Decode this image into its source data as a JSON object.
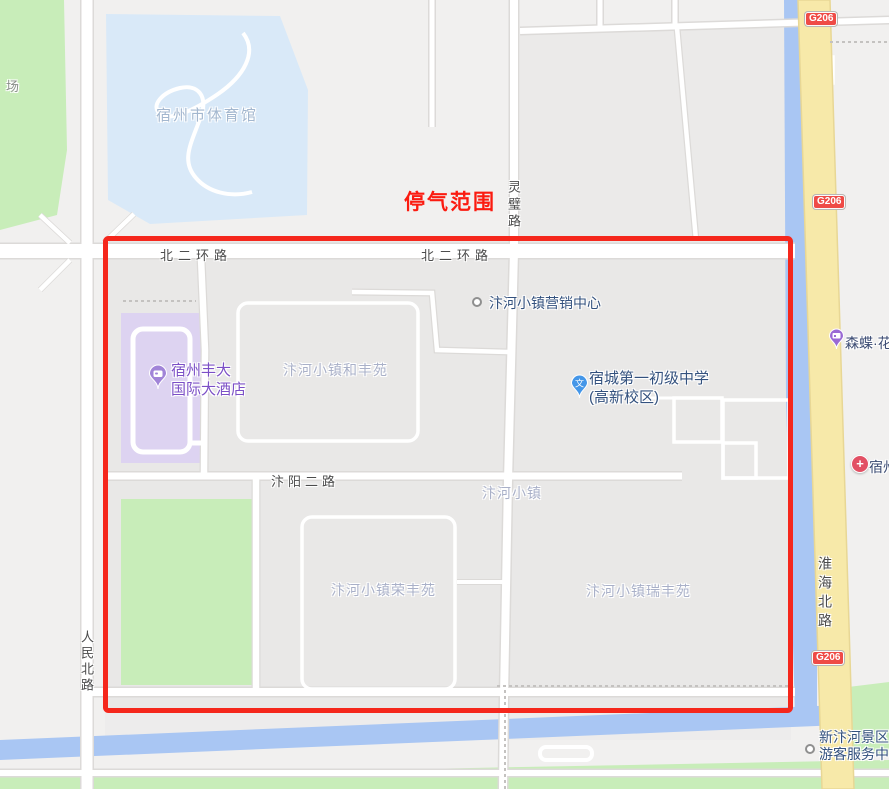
{
  "overlay": {
    "label": "停气范围"
  },
  "road_labels": {
    "beierhuan_left": "北二环路",
    "beierhuan_center": "北二环路",
    "lingbi": "灵璧路",
    "bianyang_er": "汴阳二路",
    "renmin_bei": "人民北路",
    "huaihai_bei": "淮海北路"
  },
  "highway_badge": "G206",
  "poi": {
    "chang": "场",
    "gym": "宿州市体育馆",
    "marketing": "汴河小镇营销中心",
    "hotel_line1": "宿州丰大",
    "hotel_line2": "国际大酒店",
    "school_line1": "宿城第一初级中学",
    "school_line2": "(高新校区)",
    "flower": "森蝶·花",
    "hospital": "宿州",
    "scenic_line1": "新汴河景区",
    "scenic_line2": "游客服务中"
  },
  "areas": {
    "hefeng": "汴河小镇和丰苑",
    "town": "汴河小镇",
    "rongfeng": "汴河小镇荣丰苑",
    "ruifeng": "汴河小镇瑞丰苑"
  },
  "icons": {
    "school_pin_glyph": "文",
    "hospital_cross": "+"
  },
  "colors": {
    "overlay_red": "#f5271c",
    "park_green": "#c8edb9",
    "water_blue": "#a9c6f3",
    "gym_area_blue": "#d9e9f8",
    "hotel_area_purple": "#ddd3f1",
    "hotel_text_purple": "#7b4fc6",
    "poi_text_blue": "#33517e",
    "area_label_grey": "#a9b0c8",
    "road_label_grey": "#4c4c4c",
    "highway_yellow": "#f7e9a9",
    "badge_red": "#ef4b46"
  }
}
